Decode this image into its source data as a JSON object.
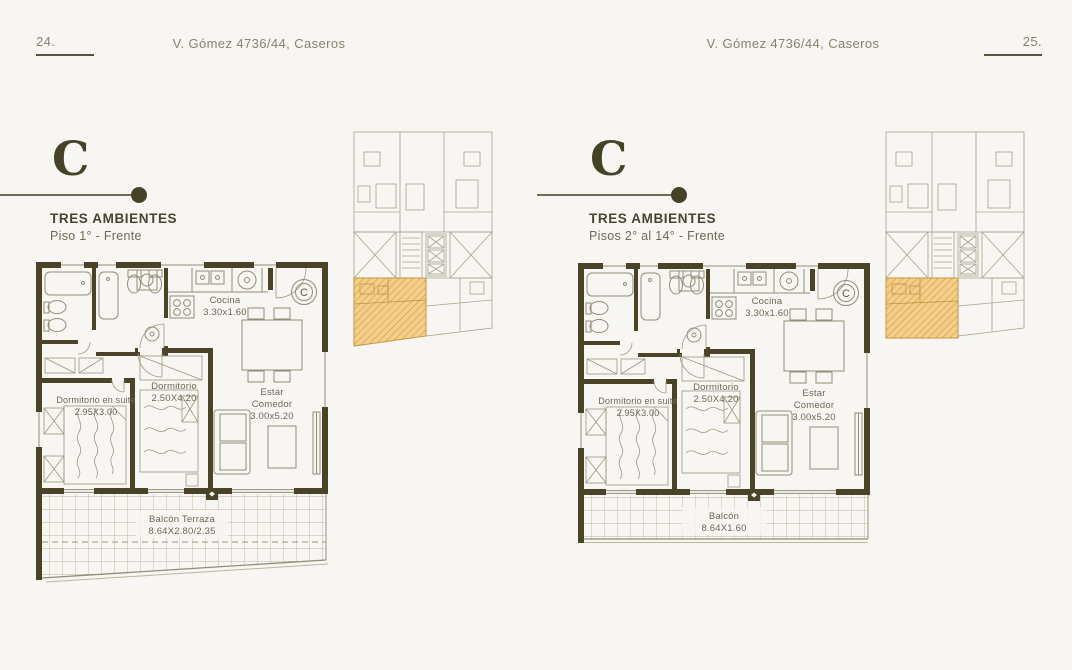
{
  "colors": {
    "background": "#f7f6f2",
    "wall": "#4a4327",
    "drawing_line": "#8f8d77",
    "accent_dark": "#454227",
    "header_text": "#84836f",
    "plan_text": "#6b6955",
    "highlight_fill": "#f3cf8e",
    "highlight_hatch": "#dfa23f"
  },
  "floor_plan": {
    "unit_marker": "C",
    "kitchen": {
      "name": "Cocina",
      "dims": "3.30x1.60"
    },
    "suite": {
      "name": "Dormitorio en suite",
      "dims": "2.95X3.00"
    },
    "bedroom": {
      "name": "Dormitorio",
      "dims": "2.50X4.20"
    },
    "living": {
      "line1": "Estar",
      "line2": "Comedor",
      "dims": "3.00x5.20"
    }
  },
  "left_page": {
    "page_number": "24.",
    "running_header": "V. Gómez 4736/44, Caseros",
    "unit_letter": "C",
    "title": "TRES AMBIENTES",
    "subtitle": "Piso 1° - Frente",
    "balcony": {
      "name": "Balcón Terraza",
      "dims": "8.64X2.80/2.35"
    }
  },
  "right_page": {
    "page_number": "25.",
    "running_header": "V. Gómez 4736/44, Caseros",
    "unit_letter": "C",
    "title": "TRES AMBIENTES",
    "subtitle": "Pisos 2° al 14° - Frente",
    "balcony": {
      "name": "Balcón",
      "dims": "8.64X1.60"
    }
  }
}
